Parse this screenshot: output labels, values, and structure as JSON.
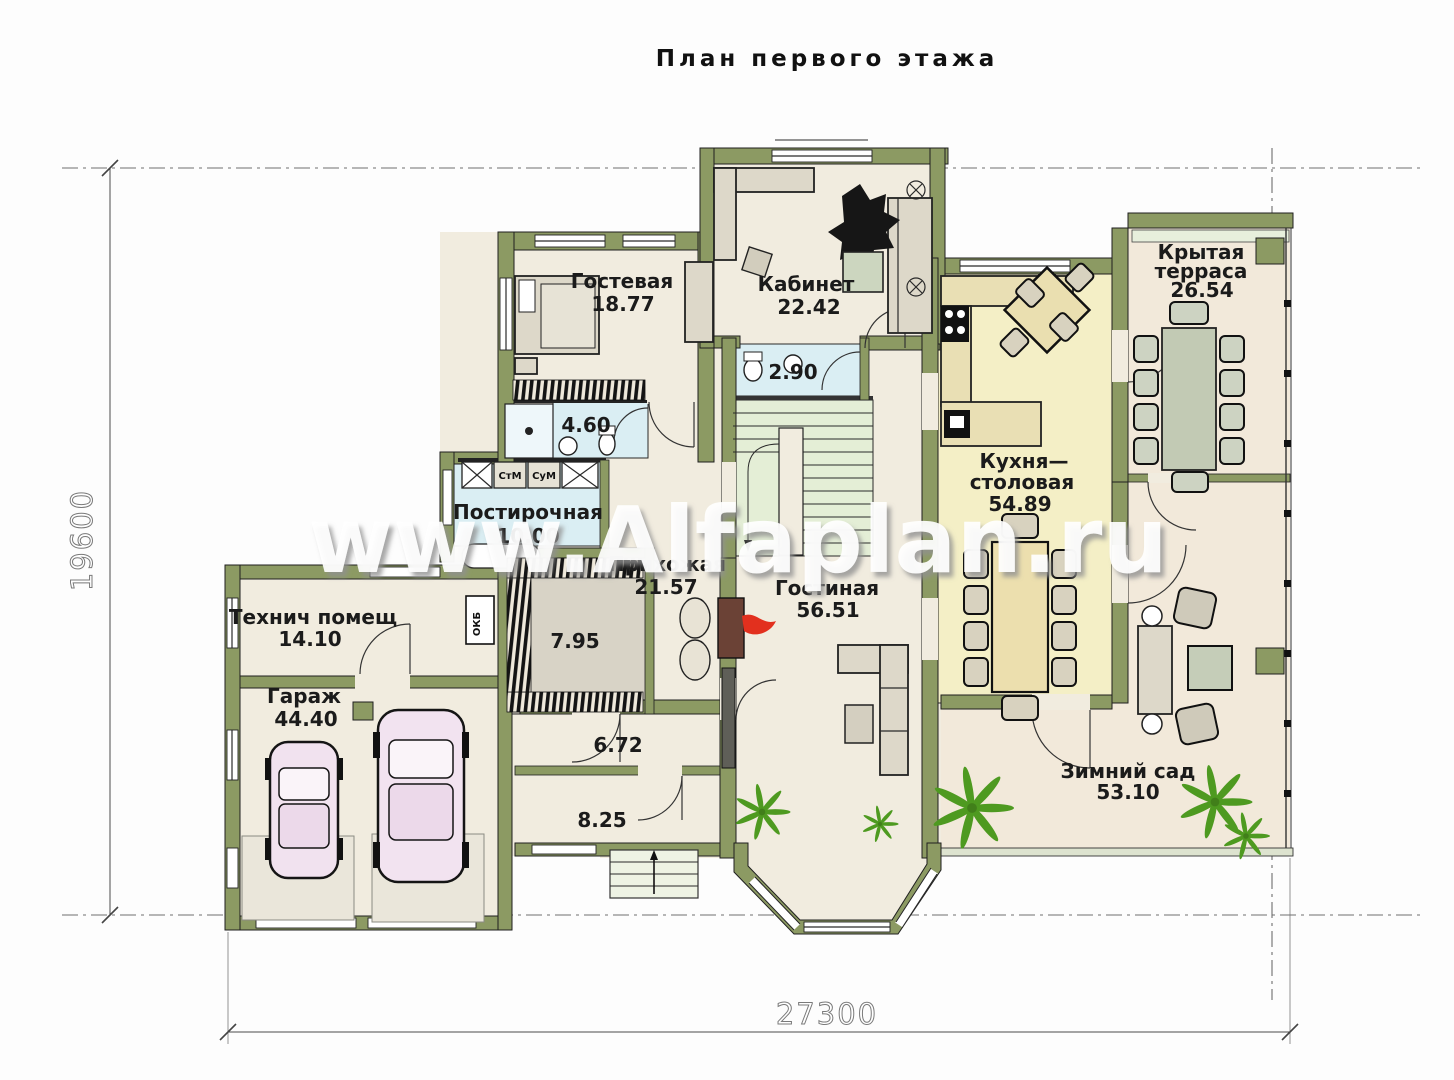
{
  "title": "План первого этажа",
  "watermark": "www.Alfaplan.ru",
  "dimensions": {
    "width": "27300",
    "height": "19600"
  },
  "rooms": {
    "guest": {
      "name": "Гостевая",
      "area": "18.77"
    },
    "office": {
      "name": "Кабинет",
      "area": "22.42"
    },
    "wc": {
      "area": "2.90"
    },
    "bath": {
      "area": "4.60"
    },
    "laundry": {
      "name": "Постирочная",
      "area": "10.00"
    },
    "hall": {
      "name": "Прихожая",
      "area": "21.57"
    },
    "dressing": {
      "area": "7.95"
    },
    "tech": {
      "name": "Технич помещ",
      "area": "14.10"
    },
    "garage": {
      "name": "Гараж",
      "area": "44.40"
    },
    "lobby": {
      "area": "6.72"
    },
    "vestibule": {
      "area": "8.25"
    },
    "living": {
      "name": "Гостиная",
      "area": "56.51"
    },
    "kitchen": {
      "name1": "Кухня—",
      "name2": "столовая",
      "area": "54.89"
    },
    "terrace": {
      "name1": "Крытая",
      "name2": "терраса",
      "area": "26.54"
    },
    "garden": {
      "name": "Зимний сад",
      "area": "53.10"
    }
  },
  "appliances": {
    "washer": "СтМ",
    "dryer": "СуМ",
    "board": "ОКБ"
  },
  "colors": {
    "wall": "#8c9a63",
    "kitchen_floor": "#f4efc6",
    "wet_floor": "#daeef3",
    "plant": "#4e9a20"
  }
}
